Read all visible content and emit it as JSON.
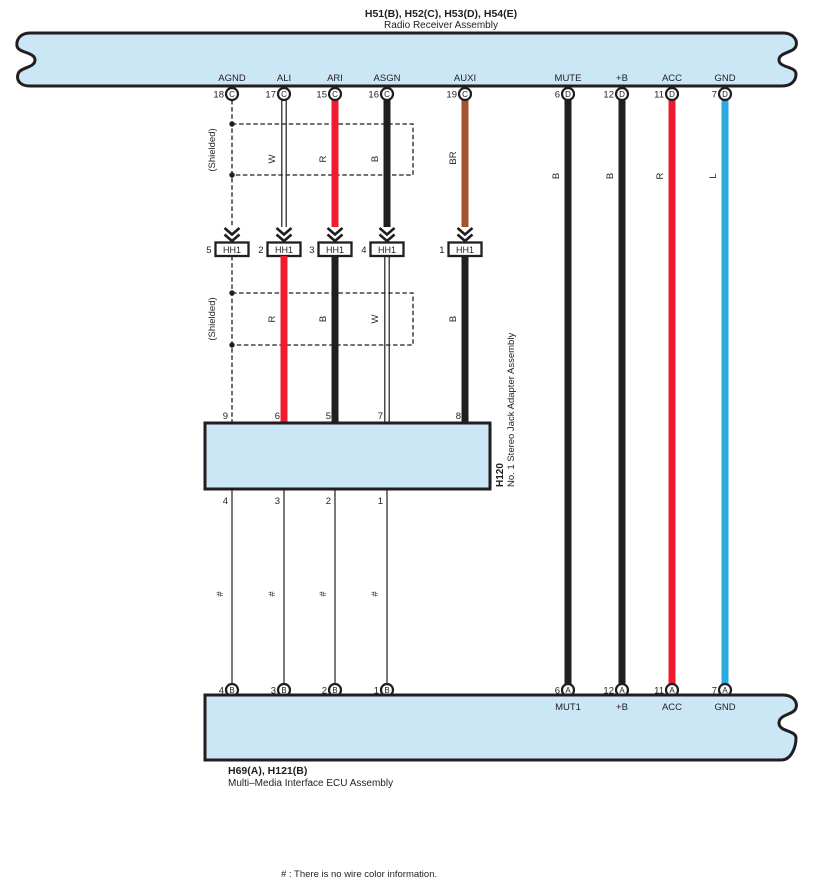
{
  "colors": {
    "band_fill": "#cbe7f6",
    "outline": "#221e1f",
    "wire_red": "#ee1c2e",
    "wire_black": "#221e1f",
    "wire_brown": "#a2542e",
    "wire_blue": "#29aae1"
  },
  "header": {
    "codes": "H51(B), H52(C), H53(D), H54(E)",
    "name": "Radio Receiver Assembly"
  },
  "adapter": {
    "code": "H120",
    "name": "No. 1 Stereo Jack Adapter Assembly"
  },
  "bottom_component": {
    "codes": "H69(A), H121(B)",
    "name": "Multi–Media Interface ECU Assembly"
  },
  "note": "# : There is no wire color information.",
  "shield_label": "(Shielded)",
  "hash_label": "#",
  "top_pins": [
    {
      "signal": "AGND",
      "pin": "18",
      "connector": "C"
    },
    {
      "signal": "ALI",
      "pin": "17",
      "connector": "C"
    },
    {
      "signal": "ARI",
      "pin": "15",
      "connector": "C"
    },
    {
      "signal": "ASGN",
      "pin": "16",
      "connector": "C"
    },
    {
      "signal": "AUXI",
      "pin": "19",
      "connector": "C"
    },
    {
      "signal": "MUTE",
      "pin": "6",
      "connector": "D"
    },
    {
      "signal": "+B",
      "pin": "12",
      "connector": "D"
    },
    {
      "signal": "ACC",
      "pin": "11",
      "connector": "D"
    },
    {
      "signal": "GND",
      "pin": "7",
      "connector": "D"
    }
  ],
  "wire_labels_upper": [
    "W",
    "R",
    "B",
    "BR"
  ],
  "wire_labels_right": [
    "B",
    "B",
    "R",
    "L"
  ],
  "wire_labels_lower": [
    "R",
    "B",
    "W",
    "B"
  ],
  "hh1_connectors": [
    {
      "pin": "5",
      "label": "HH1"
    },
    {
      "pin": "2",
      "label": "HH1"
    },
    {
      "pin": "3",
      "label": "HH1"
    },
    {
      "pin": "4",
      "label": "HH1"
    },
    {
      "pin": "1",
      "label": "HH1"
    }
  ],
  "adapter_top_pins": [
    "9",
    "6",
    "5",
    "7",
    "8"
  ],
  "adapter_bottom_pins": [
    "4",
    "3",
    "2",
    "1"
  ],
  "bottom_pins_left": [
    {
      "pin": "4",
      "connector": "B"
    },
    {
      "pin": "3",
      "connector": "B"
    },
    {
      "pin": "2",
      "connector": "B"
    },
    {
      "pin": "1",
      "connector": "B"
    }
  ],
  "bottom_pins_right": [
    {
      "pin": "6",
      "connector": "A",
      "signal": "MUT1"
    },
    {
      "pin": "12",
      "connector": "A",
      "signal": "+B"
    },
    {
      "pin": "11",
      "connector": "A",
      "signal": "ACC"
    },
    {
      "pin": "7",
      "connector": "A",
      "signal": "GND"
    }
  ]
}
